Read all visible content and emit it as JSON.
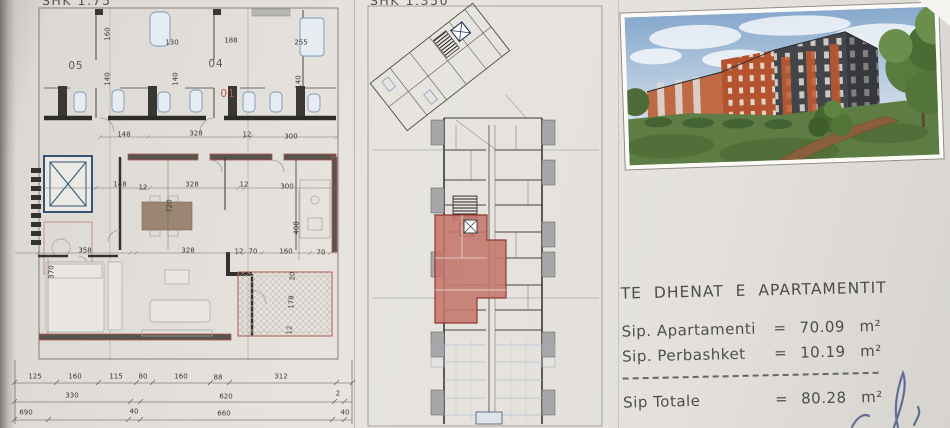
{
  "colors": {
    "accent_red": "#b5554e",
    "highlight_fill": "#c4766a",
    "fixture_blue": "#7a98b8",
    "paper": "#e6e3de",
    "ink_blue": "#4d5c8c"
  },
  "left_plan": {
    "scale_label": "SHK 1:75",
    "annotations": [
      {
        "t": "05",
        "x": 76,
        "y": 66,
        "c": "room"
      },
      {
        "t": "04",
        "x": 216,
        "y": 64,
        "c": "room"
      },
      {
        "t": "01",
        "x": 228,
        "y": 94,
        "c": "room red"
      },
      {
        "t": "160",
        "x": 108,
        "y": 34,
        "r": 1
      },
      {
        "t": "130",
        "x": 172,
        "y": 43
      },
      {
        "t": "188",
        "x": 231,
        "y": 41
      },
      {
        "t": "255",
        "x": 301,
        "y": 43
      },
      {
        "t": "140",
        "x": 108,
        "y": 79,
        "r": 1
      },
      {
        "t": "140",
        "x": 176,
        "y": 79,
        "r": 1
      },
      {
        "t": "140",
        "x": 299,
        "y": 82,
        "r": 1
      },
      {
        "t": "148",
        "x": 124,
        "y": 135
      },
      {
        "t": "328",
        "x": 196,
        "y": 134
      },
      {
        "t": "12",
        "x": 247,
        "y": 135
      },
      {
        "t": "300",
        "x": 291,
        "y": 137
      },
      {
        "t": "148",
        "x": 120,
        "y": 185
      },
      {
        "t": "12",
        "x": 143,
        "y": 188
      },
      {
        "t": "328",
        "x": 192,
        "y": 185
      },
      {
        "t": "12",
        "x": 244,
        "y": 185
      },
      {
        "t": "300",
        "x": 287,
        "y": 187
      },
      {
        "t": "720",
        "x": 170,
        "y": 206,
        "r": 1
      },
      {
        "t": "408",
        "x": 297,
        "y": 228,
        "r": 1
      },
      {
        "t": "358",
        "x": 85,
        "y": 251
      },
      {
        "t": "328",
        "x": 188,
        "y": 251
      },
      {
        "t": "12",
        "x": 239,
        "y": 252
      },
      {
        "t": "70",
        "x": 253,
        "y": 252
      },
      {
        "t": "160",
        "x": 286,
        "y": 252
      },
      {
        "t": "70",
        "x": 321,
        "y": 253
      },
      {
        "t": "370",
        "x": 52,
        "y": 272,
        "r": 1
      },
      {
        "t": "20",
        "x": 293,
        "y": 276,
        "r": 1
      },
      {
        "t": "178",
        "x": 292,
        "y": 302,
        "r": 1
      },
      {
        "t": "12",
        "x": 290,
        "y": 330,
        "r": 1
      },
      {
        "t": "125",
        "x": 35,
        "y": 377
      },
      {
        "t": "160",
        "x": 75,
        "y": 377
      },
      {
        "t": "115",
        "x": 116,
        "y": 377
      },
      {
        "t": "80",
        "x": 143,
        "y": 377
      },
      {
        "t": "160",
        "x": 181,
        "y": 377
      },
      {
        "t": "88",
        "x": 218,
        "y": 378
      },
      {
        "t": "312",
        "x": 281,
        "y": 377
      },
      {
        "t": "330",
        "x": 72,
        "y": 396
      },
      {
        "t": "620",
        "x": 226,
        "y": 397
      },
      {
        "t": "2",
        "x": 338,
        "y": 394
      },
      {
        "t": "690",
        "x": 26,
        "y": 413
      },
      {
        "t": "40",
        "x": 134,
        "y": 412
      },
      {
        "t": "660",
        "x": 224,
        "y": 414
      },
      {
        "t": "40",
        "x": 345,
        "y": 413
      }
    ]
  },
  "site_plan": {
    "scale_label": "SHK 1:350"
  },
  "info": {
    "title": "TE DHENAT E APARTAMENTIT",
    "rows": [
      {
        "label": "Sip. Apartamenti",
        "eq": "=",
        "value": "70.09",
        "unit": "m²"
      },
      {
        "label": "Sip. Perbashket",
        "eq": "=",
        "value": "10.19",
        "unit": "m²"
      }
    ],
    "total": {
      "label": "Sip Totale",
      "eq": "=",
      "value": "80.28",
      "unit": "m²"
    }
  }
}
